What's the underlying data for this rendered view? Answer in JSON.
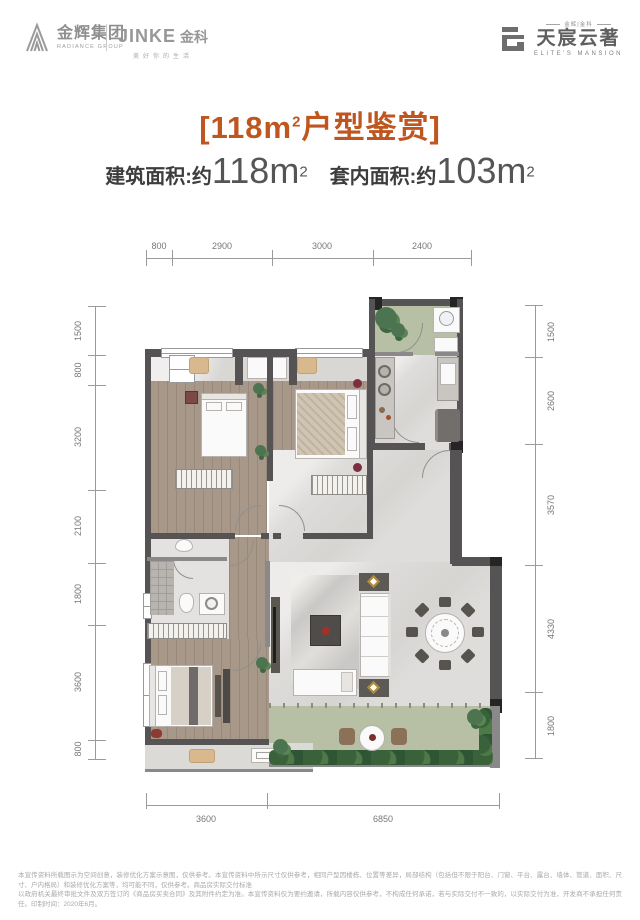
{
  "header": {
    "radiance": {
      "icon": "radiance-chevron-icon",
      "name": "金辉集团",
      "sub": "RADIANCE GROUP"
    },
    "jinke": {
      "name": "JINKE",
      "suffix": "金科",
      "slogan": "美好你的生活"
    },
    "mansion": {
      "icon": "mansion-mark-icon",
      "top": "金辉|金科",
      "name": "天宸云著",
      "sub": "ELITE'S MANSION"
    }
  },
  "title": {
    "text": "[118㎡户型鉴赏]",
    "open": "[118",
    "unit": "m",
    "sup": "2",
    "rest": "户型鉴赏]"
  },
  "area": {
    "label1": "建筑面积:约",
    "num1": "118m",
    "sup1": "2",
    "label2": "套内面积:约",
    "num2": "103m",
    "sup2": "2"
  },
  "dimensions": {
    "top": [
      "800",
      "2900",
      "3000",
      "2400"
    ],
    "left": [
      "1500",
      "800",
      "3200",
      "2100",
      "1800",
      "3600",
      "800"
    ],
    "right": [
      "1500",
      "2600",
      "3570",
      "4330",
      "1800"
    ],
    "bottom": [
      "3600",
      "6850"
    ]
  },
  "colors": {
    "accent": "#c0561f",
    "wall": "#565354",
    "wood_floor": "#a79889",
    "tile_floor": "#dedddb",
    "balcony_green": "#b7c0a4"
  },
  "disclaimer": {
    "line1": "本宣传资料所载图示为空间创意，装修优化方案示意图，仅供参考。本宣传资料中所示尺寸仅供参考，相同户型因楼栋、位置等差异，局部结构（包括但不限于阳台、门窗、平台、露台、墙体、管道、面积、尺寸、户内格局）和装修优化方案等，均可能不同，仅供参考。商品房实际交付标准",
    "line2": "以政府机关最终审批文件及双方签订的《商品房买卖合同》及其附件约定为准。本宣传资料仅为要约邀请，所载内容仅供参考，不构成任何承诺，若与实际交付不一致的，以实际交付为准，开发商不承担任何责任。印制时间：2020年6月。"
  }
}
